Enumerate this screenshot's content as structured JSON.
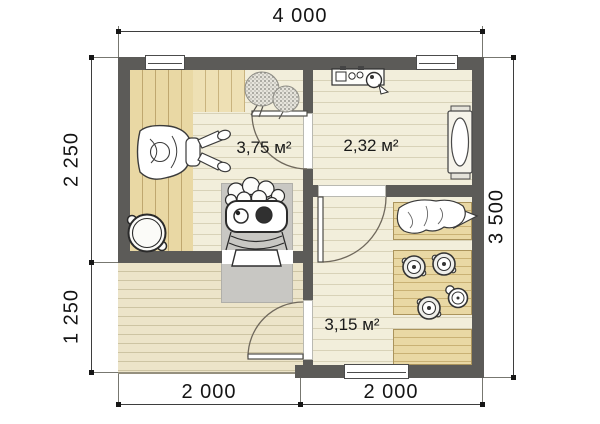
{
  "dimensions": {
    "top": "4 000",
    "left_upper": "2 250",
    "left_lower": "1 250",
    "right": "3 500",
    "bottom_left": "2 000",
    "bottom_right": "2 000"
  },
  "rooms": [
    {
      "id": "steam-room",
      "area_label": "3,75 м²"
    },
    {
      "id": "rest-room",
      "area_label": "2,32 м²"
    },
    {
      "id": "wash-room",
      "area_label": "3,15 м²"
    }
  ],
  "elements": [
    "sauna-stove-icon",
    "stove-pad",
    "water-tub-icon",
    "birch-besoms-icon",
    "lounging-person-icon",
    "steam-bench",
    "samovar-shelf-icon",
    "oval-table-bench-icon",
    "towel-pile-icon",
    "wash-basin-icon",
    "ladle-icon",
    "wash-benches",
    "terrace-deck",
    "window",
    "door-arc"
  ],
  "colors": {
    "wall": "#5c5b58",
    "floor": "#f2eedb",
    "bench_wood": "#e9d8a4",
    "deck_wood": "#ece4c9",
    "stove_pad": "#c8c7c3",
    "dim_text": "#141414"
  }
}
